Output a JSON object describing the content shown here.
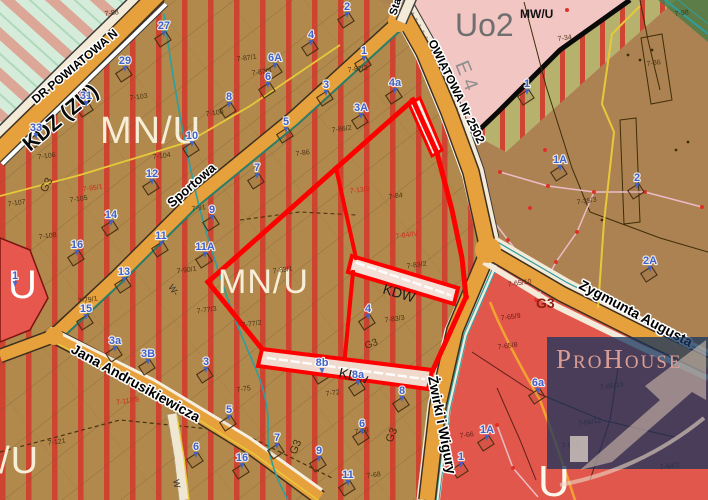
{
  "map": {
    "title": "zoning plan extract",
    "palette": {
      "mnu_base": "#b1894c",
      "mnu_stripe": "#d23a2c",
      "brown_base": "#ac8252",
      "road_orange": "#e6a13c",
      "selection_red": "#ff0000",
      "water_teal": "#2f9e9e",
      "service_red_zone": "#e2574b",
      "uo_pink": "#f2c6c2",
      "olive_zone": "#b6b26e",
      "green_zone": "#d4ecd9",
      "house_number_blue": "#3f63cb",
      "watermark_navy": "#16345e"
    },
    "zone_labels": [
      {
        "t": "MN/U",
        "x": 100,
        "y": 143,
        "s": 38,
        "c": "#f7eed8",
        "sp": 1
      },
      {
        "t": "MN/U",
        "x": 218,
        "y": 293,
        "s": 34,
        "c": "#f7eed8",
        "sp": 1
      },
      {
        "t": "MN/U",
        "x": -62,
        "y": 473,
        "s": 38,
        "c": "#f7eed8",
        "sp": 1
      },
      {
        "t": "U",
        "x": 8,
        "y": 298,
        "s": 40,
        "c": "#ffffff"
      },
      {
        "t": "U",
        "x": 538,
        "y": 496,
        "s": 44,
        "c": "#fdf6ea"
      },
      {
        "t": "Uo2",
        "x": 455,
        "y": 36,
        "s": 32,
        "c": "#6f6f6f"
      },
      {
        "t": "MW/U",
        "x": 520,
        "y": 18,
        "s": 12,
        "c": "#111111",
        "w": "bold"
      },
      {
        "t": "E 4",
        "x": 455,
        "y": 64,
        "s": 20,
        "c": "#8f8f8f",
        "r": 68
      },
      {
        "t": "KDZ (ZU)",
        "x": 30,
        "y": 152,
        "s": 21,
        "c": "#0a0a0a",
        "r": -40,
        "w": "bold",
        "halo": "#ffffff"
      },
      {
        "t": "KDW",
        "x": 382,
        "y": 293,
        "s": 14,
        "c": "#1a1a1a",
        "r": 17
      },
      {
        "t": "KDw",
        "x": 338,
        "y": 377,
        "s": 14,
        "c": "#1a1a1a",
        "r": 13
      },
      {
        "t": "G3",
        "x": 536,
        "y": 308,
        "s": 14,
        "c": "#8e1d12",
        "w": "bold"
      },
      {
        "t": "G3",
        "x": 296,
        "y": 455,
        "s": 11,
        "c": "#43300e",
        "r": -68
      },
      {
        "t": "G3",
        "x": 392,
        "y": 443,
        "s": 11,
        "c": "#43300e",
        "r": -68
      },
      {
        "t": "G3",
        "x": 366,
        "y": 349,
        "s": 10,
        "c": "#43300e",
        "r": -20
      },
      {
        "t": "G3",
        "x": 46,
        "y": 193,
        "s": 11,
        "c": "#43300e",
        "r": -62
      },
      {
        "t": "W-",
        "x": 168,
        "y": 287,
        "s": 9,
        "c": "#333333",
        "r": 55
      },
      {
        "t": "W",
        "x": 173,
        "y": 480,
        "s": 9,
        "c": "#333333",
        "r": 80
      }
    ],
    "street_labels": [
      {
        "t": "DR POWIATOWA N",
        "x": 36,
        "y": 104,
        "r": -40,
        "s": 12
      },
      {
        "t": "Sta",
        "x": 396,
        "y": 16,
        "r": -72,
        "s": 11
      },
      {
        "t": "OWIATOWA Nr 2502",
        "x": 428,
        "y": 42,
        "r": 64,
        "s": 12
      },
      {
        "t": "Sportowa",
        "x": 172,
        "y": 208,
        "r": -41,
        "s": 13
      },
      {
        "t": "Jana Andrusikiewicza",
        "x": 70,
        "y": 352,
        "r": 29,
        "s": 14
      },
      {
        "t": "Żwirki i Wigury",
        "x": 428,
        "y": 377,
        "r": 79,
        "s": 14
      },
      {
        "t": "Zygmunta Augusta",
        "x": 578,
        "y": 288,
        "r": 28,
        "s": 14
      }
    ],
    "house_numbers": [
      {
        "t": "27",
        "x": 164,
        "y": 29
      },
      {
        "t": "29",
        "x": 125,
        "y": 64
      },
      {
        "t": "31",
        "x": 86,
        "y": 99
      },
      {
        "t": "33",
        "x": 36,
        "y": 131
      },
      {
        "t": "8",
        "x": 229,
        "y": 100
      },
      {
        "t": "10",
        "x": 192,
        "y": 139
      },
      {
        "t": "2",
        "x": 347,
        "y": 10
      },
      {
        "t": "4",
        "x": 311,
        "y": 38
      },
      {
        "t": "6A",
        "x": 275,
        "y": 61
      },
      {
        "t": "6",
        "x": 268,
        "y": 80
      },
      {
        "t": "1",
        "x": 364,
        "y": 54
      },
      {
        "t": "3",
        "x": 326,
        "y": 88
      },
      {
        "t": "4a",
        "x": 395,
        "y": 86
      },
      {
        "t": "3A",
        "x": 361,
        "y": 111
      },
      {
        "t": "5",
        "x": 286,
        "y": 125
      },
      {
        "t": "7",
        "x": 257,
        "y": 171
      },
      {
        "t": "1",
        "x": 527,
        "y": 87
      },
      {
        "t": "1A",
        "x": 560,
        "y": 163
      },
      {
        "t": "2",
        "x": 637,
        "y": 181
      },
      {
        "t": "2A",
        "x": 650,
        "y": 264
      },
      {
        "t": "12",
        "x": 152,
        "y": 177
      },
      {
        "t": "14",
        "x": 111,
        "y": 218
      },
      {
        "t": "9",
        "x": 212,
        "y": 213
      },
      {
        "t": "16",
        "x": 77,
        "y": 248
      },
      {
        "t": "11",
        "x": 161,
        "y": 239
      },
      {
        "t": "11A",
        "x": 205,
        "y": 250
      },
      {
        "t": "13",
        "x": 124,
        "y": 275
      },
      {
        "t": "15",
        "x": 86,
        "y": 312
      },
      {
        "t": "4",
        "x": 368,
        "y": 312
      },
      {
        "t": "3a",
        "x": 115,
        "y": 344
      },
      {
        "t": "3B",
        "x": 148,
        "y": 357
      },
      {
        "t": "3",
        "x": 206,
        "y": 365
      },
      {
        "t": "5",
        "x": 229,
        "y": 413
      },
      {
        "t": "6",
        "x": 196,
        "y": 450
      },
      {
        "t": "8b",
        "x": 322,
        "y": 366
      },
      {
        "t": "8a",
        "x": 358,
        "y": 378
      },
      {
        "t": "8",
        "x": 402,
        "y": 394
      },
      {
        "t": "6",
        "x": 362,
        "y": 427
      },
      {
        "t": "16",
        "x": 242,
        "y": 461
      },
      {
        "t": "7",
        "x": 277,
        "y": 441
      },
      {
        "t": "9",
        "x": 319,
        "y": 454
      },
      {
        "t": "11",
        "x": 348,
        "y": 478
      },
      {
        "t": "1A",
        "x": 487,
        "y": 433
      },
      {
        "t": "1",
        "x": 461,
        "y": 460
      },
      {
        "t": "6a",
        "x": 538,
        "y": 386
      },
      {
        "t": "1",
        "x": 15,
        "y": 279,
        "nb": true
      }
    ],
    "parcel_labels": [
      {
        "t": "7-88",
        "x": 112,
        "y": 15
      },
      {
        "t": "7-98",
        "x": 682,
        "y": 15
      },
      {
        "t": "7-34",
        "x": 565,
        "y": 40
      },
      {
        "t": "7-36",
        "x": 654,
        "y": 65
      },
      {
        "t": "7-35/3",
        "x": 587,
        "y": 203
      },
      {
        "t": "7-87/1",
        "x": 247,
        "y": 60
      },
      {
        "t": "7-87/4",
        "x": 262,
        "y": 74
      },
      {
        "t": "7-87/2",
        "x": 358,
        "y": 71
      },
      {
        "t": "7-86/2",
        "x": 342,
        "y": 131
      },
      {
        "t": "7-86",
        "x": 303,
        "y": 155
      },
      {
        "t": "7-103",
        "x": 139,
        "y": 99
      },
      {
        "t": "7-100",
        "x": 215,
        "y": 115
      },
      {
        "t": "7-104",
        "x": 162,
        "y": 158
      },
      {
        "t": "7-106",
        "x": 47,
        "y": 158
      },
      {
        "t": "7-105",
        "x": 79,
        "y": 201
      },
      {
        "t": "7-107",
        "x": 17,
        "y": 205
      },
      {
        "t": "7-108",
        "x": 48,
        "y": 238
      },
      {
        "t": "7-91",
        "x": 199,
        "y": 210
      },
      {
        "t": "7-90/1",
        "x": 187,
        "y": 272
      },
      {
        "t": "7-95/1",
        "x": 93,
        "y": 190,
        "c": "#cc2a1e"
      },
      {
        "t": "7-77/3",
        "x": 207,
        "y": 312
      },
      {
        "t": "7-77/2",
        "x": 252,
        "y": 326
      },
      {
        "t": "7-79/1",
        "x": 88,
        "y": 302
      },
      {
        "t": "7-83/1",
        "x": 283,
        "y": 272
      },
      {
        "t": "7-83/3",
        "x": 395,
        "y": 321
      },
      {
        "t": "7-83/2",
        "x": 417,
        "y": 267
      },
      {
        "t": "7-84",
        "x": 396,
        "y": 198
      },
      {
        "t": "7-13/9",
        "x": 360,
        "y": 192,
        "c": "#cc2a1e"
      },
      {
        "t": "7-84/IV",
        "x": 407,
        "y": 237,
        "c": "#cc2a1e"
      },
      {
        "t": "7-121",
        "x": 57,
        "y": 444
      },
      {
        "t": "7-117/8",
        "x": 128,
        "y": 403,
        "c": "#cc2a1e"
      },
      {
        "t": "7-75",
        "x": 244,
        "y": 391
      },
      {
        "t": "7-72",
        "x": 333,
        "y": 395
      },
      {
        "t": "7-69",
        "x": 362,
        "y": 433
      },
      {
        "t": "7-68",
        "x": 374,
        "y": 477
      },
      {
        "t": "7-66",
        "x": 467,
        "y": 437,
        "c": "#6b1d14"
      },
      {
        "t": "7-65/8",
        "x": 508,
        "y": 348,
        "c": "#6b1d14"
      },
      {
        "t": "7-65/13",
        "x": 612,
        "y": 388,
        "c": "#6b1d14"
      },
      {
        "t": "7-65/10",
        "x": 520,
        "y": 285,
        "c": "#6b1d14"
      },
      {
        "t": "7-65/9",
        "x": 511,
        "y": 319,
        "c": "#6b1d14"
      },
      {
        "t": "7-64/2",
        "x": 670,
        "y": 468,
        "c": "#6b1d14"
      },
      {
        "t": "7-66/12",
        "x": 590,
        "y": 424,
        "c": "#6b1d14"
      },
      {
        "t": "7-61/1",
        "x": 572,
        "y": 447,
        "c": "#6b1d14"
      }
    ],
    "watermark": {
      "brand": "ProHouse"
    }
  }
}
